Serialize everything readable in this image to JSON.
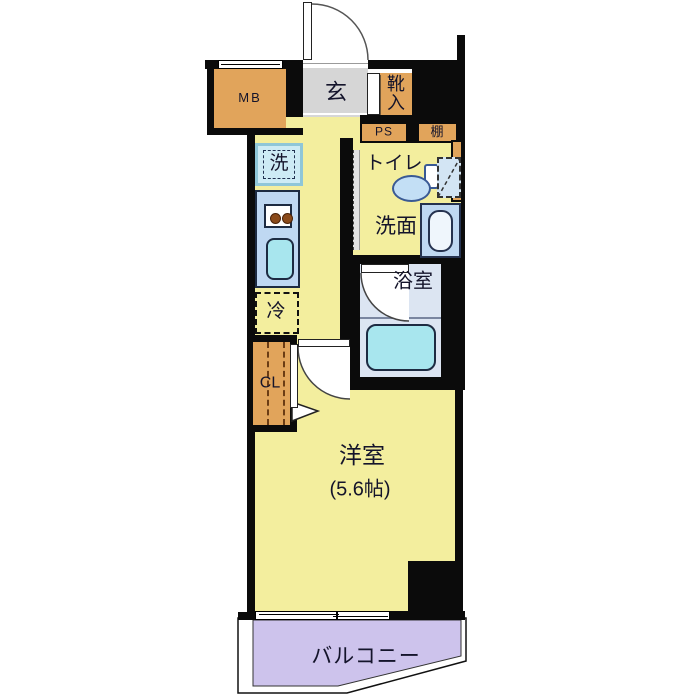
{
  "floorplan": {
    "title": "1K apartment floor plan",
    "labels": {
      "mb": "MB",
      "genkan": "玄",
      "shoes": "靴入",
      "ps": "PS",
      "shelf": "棚",
      "toilet": "トイレ",
      "washroom": "洗面",
      "bathroom": "浴室",
      "washer": "洗",
      "fridge": "冷",
      "closet": "CL",
      "room": "洋室",
      "room_size": "(5.6帖)",
      "balcony": "バルコニー"
    },
    "colors": {
      "wall": "#0b0b0b",
      "room_yellow": "#F3EE9E",
      "service_orange": "#E1A45B",
      "genkan_gray": "#D6D6D6",
      "fixture_blue": "#BFD8F2",
      "washer_blue": "#CDEBF5",
      "sink_cyan": "#A8E6EE",
      "bathroom_bg": "#DCE5F2",
      "balcony_purple": "#CDC3EC",
      "text": "#14142b"
    }
  }
}
